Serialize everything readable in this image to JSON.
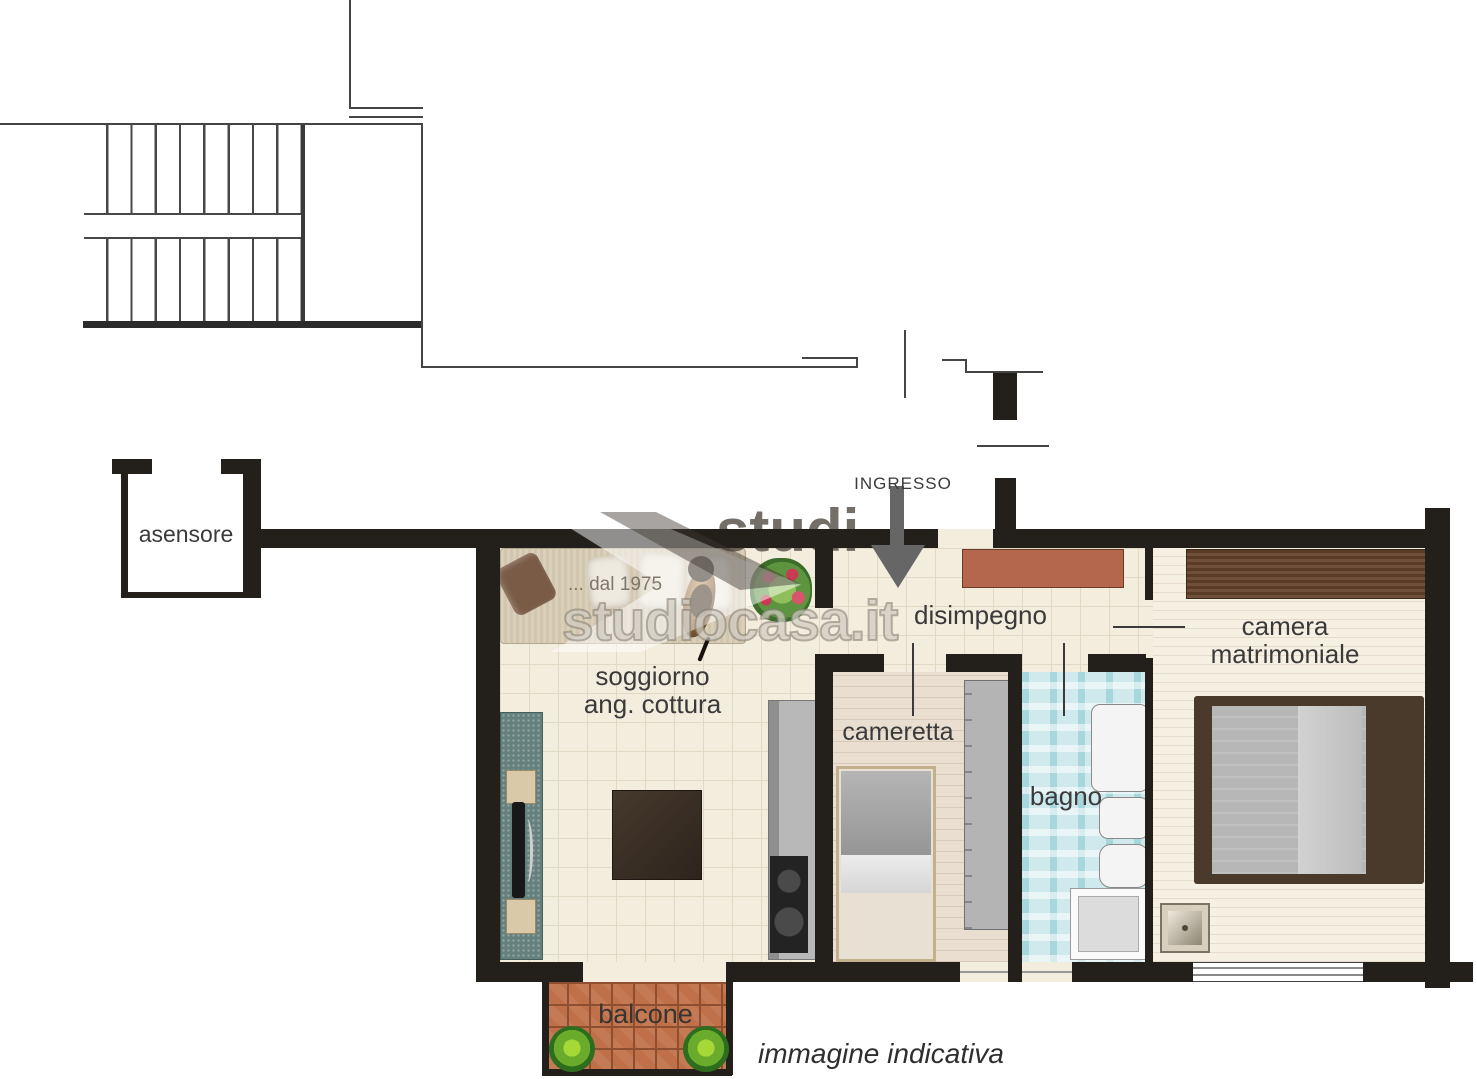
{
  "rooms": {
    "elevator": {
      "label": "asensore"
    },
    "entrance": {
      "label": "INGRESSO"
    },
    "living": {
      "line1": "soggiorno",
      "line2": "ang. cottura"
    },
    "hallway": {
      "label": "disimpegno"
    },
    "child_bedroom": {
      "label": "cameretta"
    },
    "bathroom": {
      "label": "bagno"
    },
    "master_bedroom": {
      "line1": "camera",
      "line2": "matrimoniale"
    },
    "balcony": {
      "label": "balcone"
    }
  },
  "watermark": {
    "brand": "studiocasa.it",
    "brand_fragment": "studi",
    "since": "... dal 1975"
  },
  "note": {
    "text": "immagine indicativa"
  },
  "colors": {
    "wall": "#231f1b",
    "line": "#454545",
    "tile_floor": "#f3eddd",
    "tile_line": "#e1d9c3",
    "child_floor": "#e9decf",
    "master_floor": "#f6f0e3",
    "bath_floor": "#cfe9ec",
    "brick": "#c07048",
    "brick_line": "#8e4f30",
    "cabinet_accent": "#b5674d",
    "arrow": "#666666",
    "label": "#3a3a3a"
  }
}
